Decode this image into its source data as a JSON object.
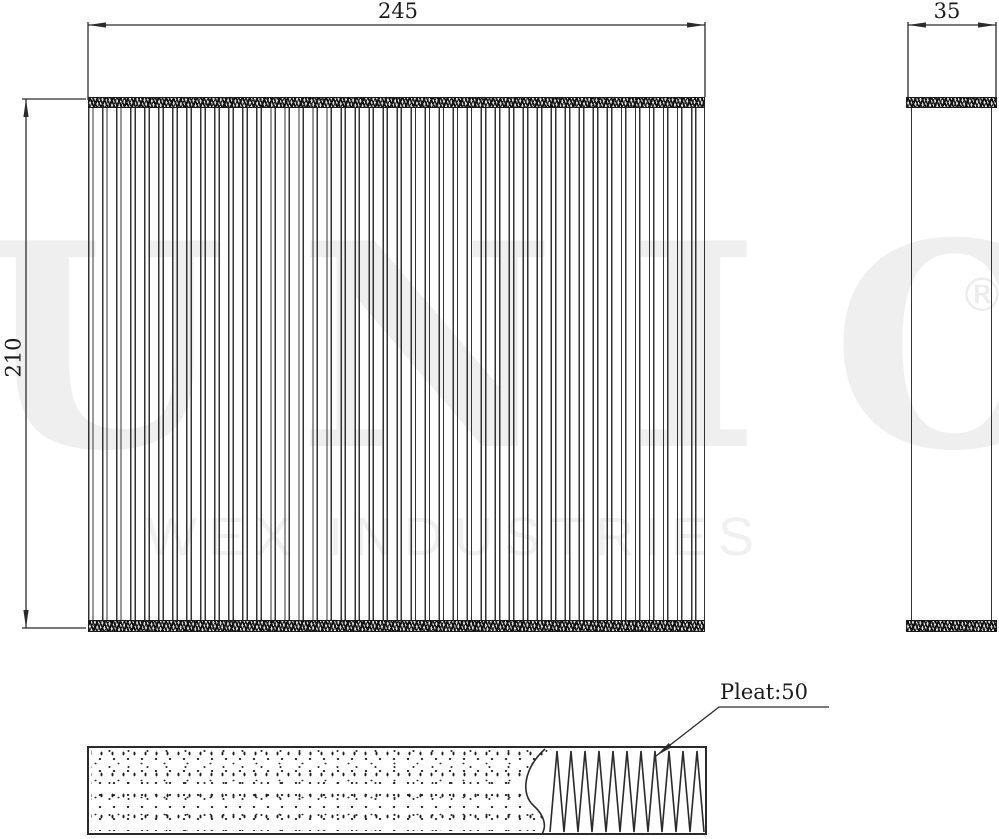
{
  "drawing": {
    "dim_width_label": "245",
    "dim_height_label": "210",
    "dim_depth_label": "35",
    "pleat_annotation": "Pleat:50"
  },
  "watermark": {
    "brand": "UNIO",
    "registered_symbol": "®",
    "subtitle": "WEX INDUSTRIES"
  },
  "colors": {
    "line": "#2b2b2b",
    "watermark_gray": "#efefef"
  }
}
